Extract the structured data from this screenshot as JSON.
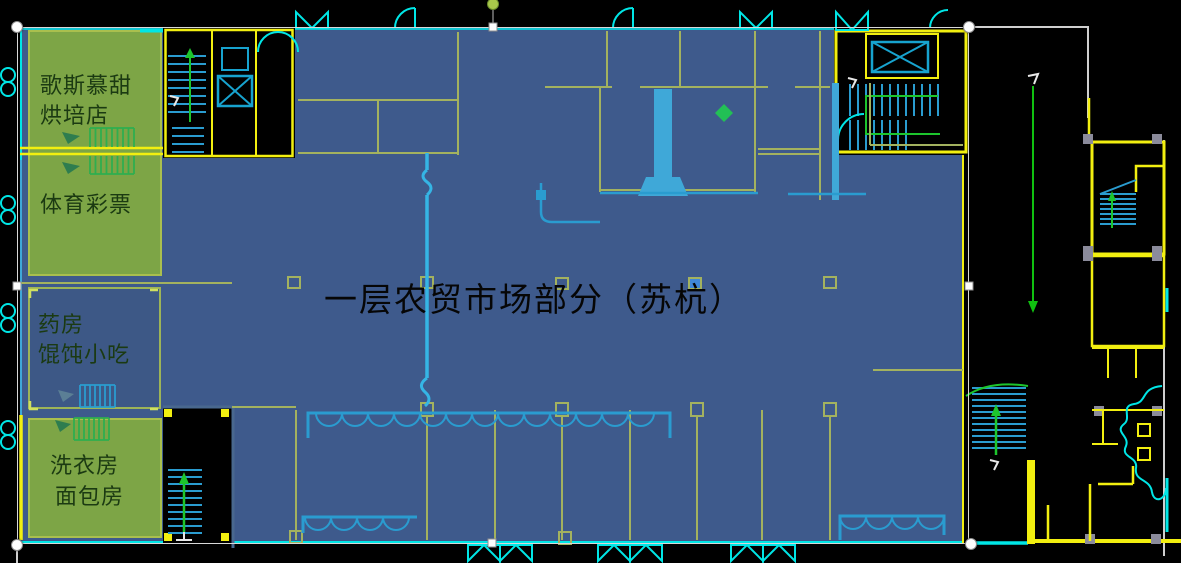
{
  "title": {
    "text": "一层农贸市场部分（苏杭）"
  },
  "shops": {
    "bakery": {
      "line1": "歌斯慕甜",
      "line2": "烘培店"
    },
    "lottery": {
      "line1": "体育彩票"
    },
    "pharmacy": {
      "line1": "药房",
      "line2": "馄饨小吃"
    },
    "laundry": {
      "line1": "洗衣房",
      "line2": "面包房"
    }
  },
  "colors": {
    "background": "#000000",
    "overlay_blue": "#3e5a8c",
    "label_green": "#7da546",
    "label_text_green": "#1b3a12",
    "cad_yellow": "#f2ef10",
    "cad_cyan": "#00e6e6",
    "cad_blue": "#2a9cd0",
    "cad_olive": "#a3b25f",
    "cad_green": "#1dc52d",
    "selection_white": "#d8d8d8",
    "rotation_handle_green": "#a9c84b",
    "title_text": "#060606"
  }
}
